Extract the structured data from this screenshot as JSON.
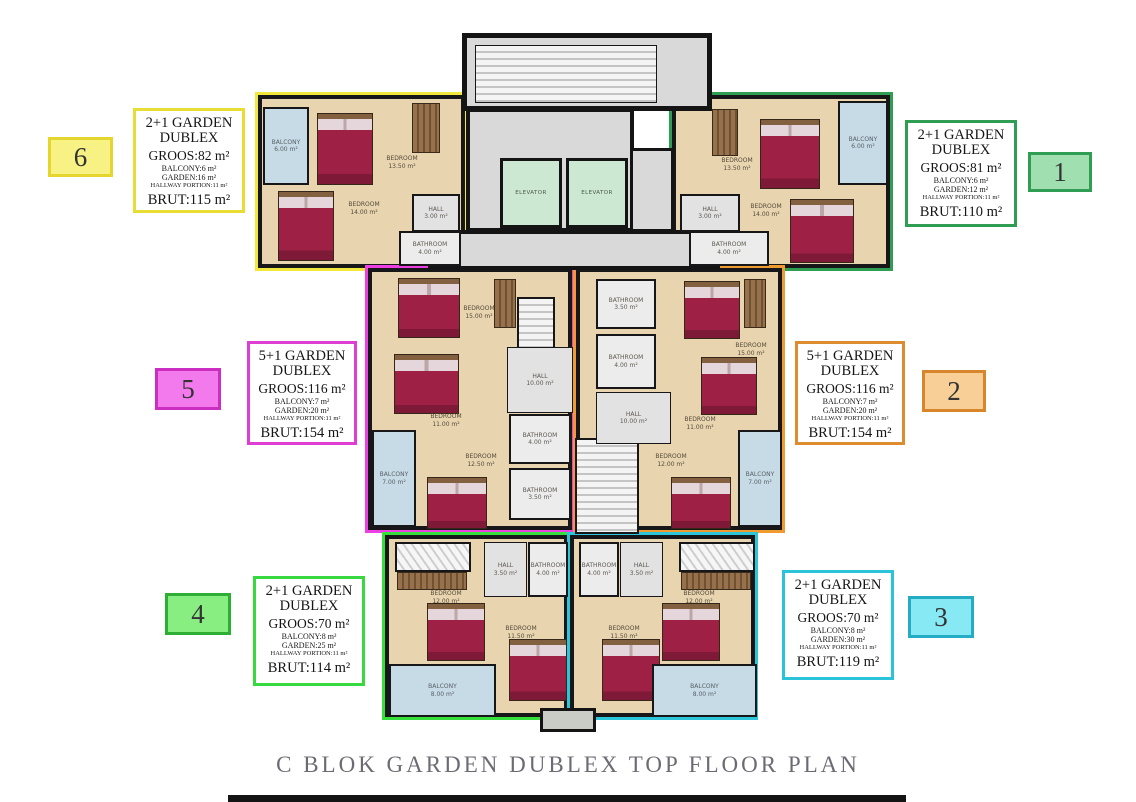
{
  "title": "C BLOK GARDEN DUBLEX TOP FLOOR PLAN",
  "info_boxes": {
    "b6": {
      "number": "6",
      "type_line1": "2+1 GARDEN",
      "type_line2": "DUBLEX",
      "groos": "GROOS:82 m²",
      "balcony": "BALCONY:6 m²",
      "garden": "GARDEN:16 m²",
      "hallway": "HALLWAY PORTION:11 m²",
      "brut": "BRUT:115 m²",
      "accent": "#f0e83c"
    },
    "b1": {
      "number": "1",
      "type_line1": "2+1 GARDEN",
      "type_line2": "DUBLEX",
      "groos": "GROOS:81 m²",
      "balcony": "BALCONY:6 m²",
      "garden": "GARDEN:12 m²",
      "hallway": "HALLWAY PORTION:11 m²",
      "brut": "BRUT:110 m²",
      "accent": "#2f9e53"
    },
    "b5": {
      "number": "5",
      "type_line1": "5+1 GARDEN",
      "type_line2": "DUBLEX",
      "groos": "GROOS:116 m²",
      "balcony": "BALCONY:7 m²",
      "garden": "GARDEN:20 m²",
      "hallway": "HALLWAY PORTION:11 m²",
      "brut": "BRUT:154 m²",
      "accent": "#ee3fe2"
    },
    "b2": {
      "number": "2",
      "type_line1": "5+1 GARDEN",
      "type_line2": "DUBLEX",
      "groos": "GROOS:116 m²",
      "balcony": "BALCONY:7 m²",
      "garden": "GARDEN:20 m²",
      "hallway": "HALLWAY PORTION:11 m²",
      "brut": "BRUT:154 m²",
      "accent": "#ef9b2f"
    },
    "b4": {
      "number": "4",
      "type_line1": "2+1 GARDEN",
      "type_line2": "DUBLEX",
      "groos": "GROOS:70 m²",
      "balcony": "BALCONY:8 m²",
      "garden": "GARDEN:25 m²",
      "hallway": "HALLWAY PORTION:11 m²",
      "brut": "BRUT:114 m²",
      "accent": "#35e03c"
    },
    "b3": {
      "number": "3",
      "type_line1": "2+1 GARDEN",
      "type_line2": "DUBLEX",
      "groos": "GROOS:70 m²",
      "balcony": "BALCONY:8 m²",
      "garden": "GARDEN:30 m²",
      "hallway": "HALLWAY PORTION:11 m²",
      "brut": "BRUT:119 m²",
      "accent": "#2cc5da"
    }
  },
  "rooms": {
    "elevator": "ELEVATOR",
    "u6": {
      "balcony": {
        "n": "BALCONY",
        "a": "6.00 m²"
      },
      "bed1": {
        "n": "BEDROOM",
        "a": "13.50 m²"
      },
      "bed2": {
        "n": "BEDROOM",
        "a": "14.00 m²"
      },
      "hall": {
        "n": "HALL",
        "a": "3.00 m²"
      },
      "bath": {
        "n": "BATHROOM",
        "a": "4.00 m²"
      }
    },
    "u1": {
      "balcony": {
        "n": "BALCONY",
        "a": "6.00 m²"
      },
      "bed1": {
        "n": "BEDROOM",
        "a": "13.50 m²"
      },
      "bed2": {
        "n": "BEDROOM",
        "a": "14.00 m²"
      },
      "hall": {
        "n": "HALL",
        "a": "3.00 m²"
      },
      "bath": {
        "n": "BATHROOM",
        "a": "4.00 m²"
      }
    },
    "u5": {
      "bed1": {
        "n": "BEDROOM",
        "a": "15.00 m²"
      },
      "bed2": {
        "n": "BEDROOM",
        "a": "11.00 m²"
      },
      "bed3": {
        "n": "BEDROOM",
        "a": "12.50 m²"
      },
      "balcony": {
        "n": "BALCONY",
        "a": "7.00 m²"
      },
      "bath1": {
        "n": "BATHROOM",
        "a": "4.00 m²"
      },
      "bath2": {
        "n": "BATHROOM",
        "a": "3.50 m²"
      },
      "hall": {
        "n": "HALL",
        "a": "10.00 m²"
      }
    },
    "u2": {
      "bed1": {
        "n": "BEDROOM",
        "a": "15.00 m²"
      },
      "bed2": {
        "n": "BEDROOM",
        "a": "11.00 m²"
      },
      "bed3": {
        "n": "BEDROOM",
        "a": "12.00 m²"
      },
      "balcony": {
        "n": "BALCONY",
        "a": "7.00 m²"
      },
      "bath1": {
        "n": "BATHROOM",
        "a": "3.50 m²"
      },
      "bath2": {
        "n": "BATHROOM",
        "a": "4.00 m²"
      },
      "hall": {
        "n": "HALL",
        "a": "10.00 m²"
      }
    },
    "u4": {
      "bed1": {
        "n": "BEDROOM",
        "a": "12.00 m²"
      },
      "bed2": {
        "n": "BEDROOM",
        "a": "11.50 m²"
      },
      "hall": {
        "n": "HALL",
        "a": "3.50 m²"
      },
      "bath": {
        "n": "BATHROOM",
        "a": "4.00 m²"
      },
      "balcony": {
        "n": "BALCONY",
        "a": "8.00 m²"
      }
    },
    "u3": {
      "bed1": {
        "n": "BEDROOM",
        "a": "12.00 m²"
      },
      "bed2": {
        "n": "BEDROOM",
        "a": "11.50 m²"
      },
      "hall": {
        "n": "HALL",
        "a": "3.50 m²"
      },
      "bath": {
        "n": "BATHROOM",
        "a": "4.00 m²"
      },
      "balcony": {
        "n": "BALCONY",
        "a": "8.00 m²"
      }
    }
  },
  "colors": {
    "wall": "#17171a",
    "floor": "#e8d5b0",
    "balcony_fill": "#c7dbe6",
    "elevator_fill": "#cde8d2",
    "bed_blanket": "#9e2145"
  }
}
